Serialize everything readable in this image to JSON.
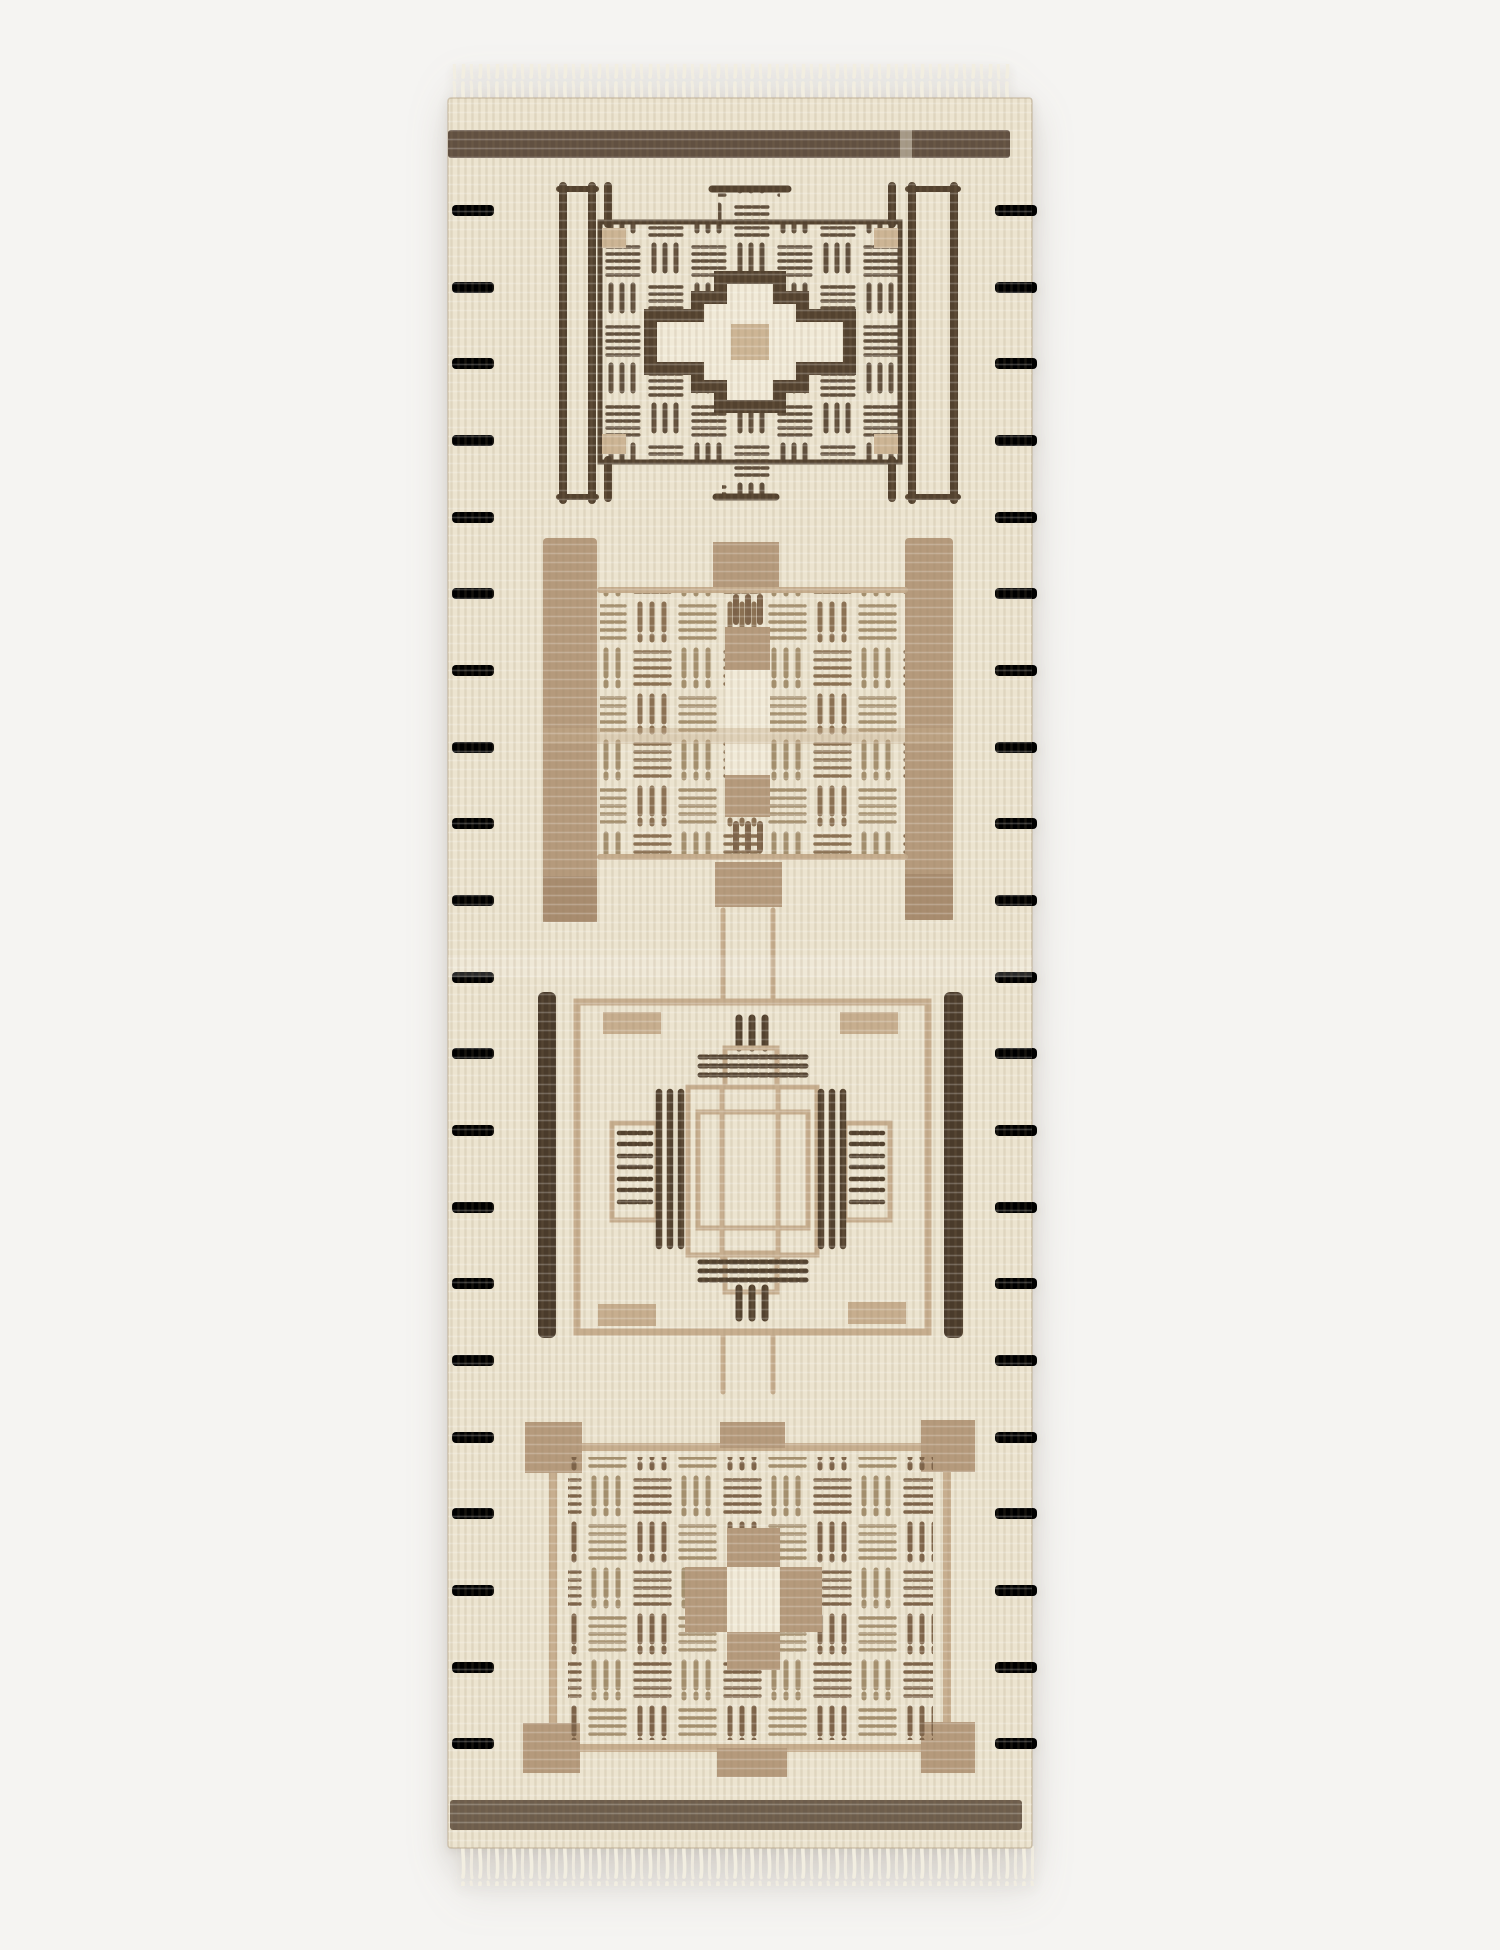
{
  "image": {
    "kind": "product-photograph",
    "alt": "Hand-knotted cream wool runner rug, photographed flat on a white studio background, with fringe at both ends and four stacked geometric medallions in dark brown, taupe and tan",
    "orientation": "vertical runner",
    "background": "#f5f4f2"
  },
  "palette": {
    "bg": "#f5f4f2",
    "cream": "#ece4d0",
    "cream2": "#f1ead8",
    "fringe": "#f2eee1",
    "band": "#615041",
    "band2": "#6d5d4c",
    "dark": "#53422f",
    "dark2": "#4a3b2b",
    "med": "#8b7153",
    "medlt": "#a5906f",
    "med2": "#7d6349",
    "tan": "#b59a7c",
    "tanline": "#c7ae8f",
    "tancenter": "#cdb595"
  },
  "rug": {
    "fringe": {
      "top": "short cream fringe",
      "bottom": "short cream fringe"
    },
    "bands": {
      "top": "dark brown horizontal bar below top edge",
      "bottom": "dark brown horizontal bar above bottom edge"
    },
    "side_dashes": {
      "per_side": 21,
      "description": "short tan horizontal dashes running down both selvedge edges"
    },
    "medallions": [
      {
        "id": "medallion-1",
        "name": "Dark brown basketweave block with stepped cream diamond core, tan center square, flanking double pin-stripes and corner legs"
      },
      {
        "id": "medallion-2",
        "name": "Taupe medallion: tan side columns, top and bottom blocks, basketweave stripe fill with tan-and-cream center column"
      },
      {
        "id": "medallion-3",
        "name": "Open tan square outline with dark side bars, tan corner ticks and stepped cross center motif with dark pin-stripes"
      },
      {
        "id": "medallion-4",
        "name": "Tan-framed basketweave block with protruding corner blocks and tan plus-shaped center around cream core"
      }
    ]
  }
}
